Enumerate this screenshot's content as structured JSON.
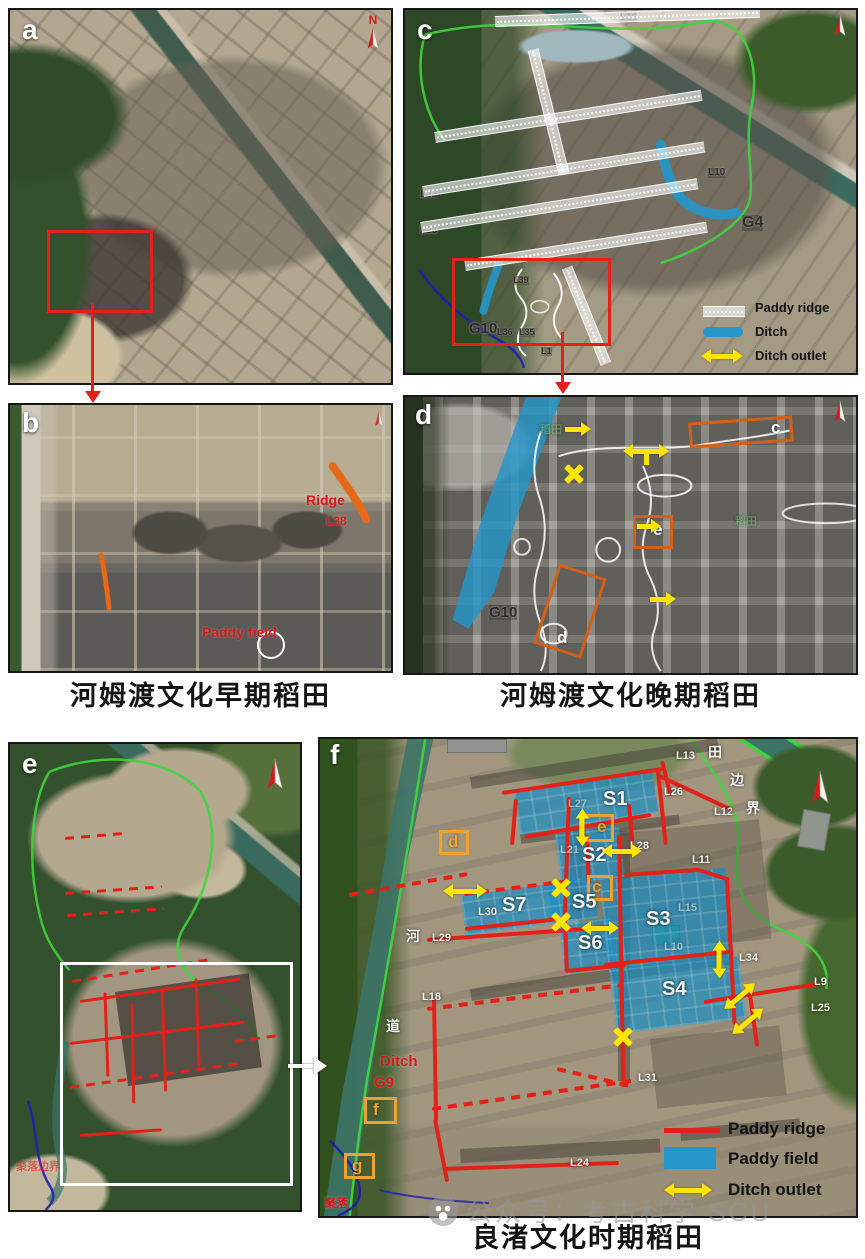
{
  "colors": {
    "annotation_red": "#e32119",
    "ditch_blue": "#2596c8",
    "outlet_yellow": "#ffe400",
    "box_orange": "#f0a030",
    "boundary_green": "#3fd43f",
    "boundary_navy": "#1f1fae"
  },
  "watermark": {
    "text": "公众号：考古科学 SCU"
  },
  "panel_a": {
    "letter": "a",
    "north_label": "N"
  },
  "panel_b": {
    "letter": "b",
    "caption": "河姆渡文化早期稻田",
    "labels": {
      "ridge": "Ridge",
      "l38": "L38",
      "paddy_field": "Paddy field"
    }
  },
  "panel_c": {
    "letter": "c",
    "labels": {
      "l16": "L16",
      "l32": "L32",
      "l23": "L23",
      "l10": "L10",
      "g4": "G4",
      "g10": "G10",
      "l39": "L39",
      "l36": "L36",
      "l35": "L35",
      "l1": "L1"
    },
    "legend": {
      "paddy_ridge": "Paddy ridge",
      "ditch": "Ditch",
      "ditch_outlet": "Ditch outlet"
    }
  },
  "panel_d": {
    "letter": "d",
    "caption": "河姆渡文化晚期稻田",
    "labels": {
      "g10": "G10",
      "ground_mark_1": "稻田",
      "ground_mark_2": "稻田"
    },
    "boxes": {
      "c": "c",
      "d": "d",
      "e": "e"
    }
  },
  "panel_e": {
    "letter": "e",
    "labels": {
      "boundary_note": "聚落边界"
    }
  },
  "panel_f": {
    "letter": "f",
    "caption": "良渚文化时期稻田",
    "fields": {
      "s1": "S1",
      "s2": "S2",
      "s3": "S3",
      "s4": "S4",
      "s5": "S5",
      "s6": "S6",
      "s7": "S7"
    },
    "labels": {
      "l13": "L13",
      "tian": "田",
      "bian": "边",
      "jie": "界",
      "l26": "L26",
      "l27": "L27",
      "l12": "L12",
      "l28": "L28",
      "l11": "L11",
      "l21": "L21",
      "l30": "L30",
      "l15": "L15",
      "l29": "L29",
      "he": "河",
      "l10": "L10",
      "l34": "L34",
      "l9": "L9",
      "l18": "L18",
      "l25": "L25",
      "dao": "道",
      "l31": "L31",
      "l24": "L24",
      "juluo": "聚落",
      "ditch": "Ditch",
      "g9": "G9"
    },
    "boxes": {
      "c": "c",
      "d": "d",
      "e": "e",
      "f": "f",
      "g": "g"
    },
    "legend": {
      "paddy_ridge": "Paddy ridge",
      "paddy_field": "Paddy field",
      "ditch_outlet": "Ditch outlet"
    }
  }
}
